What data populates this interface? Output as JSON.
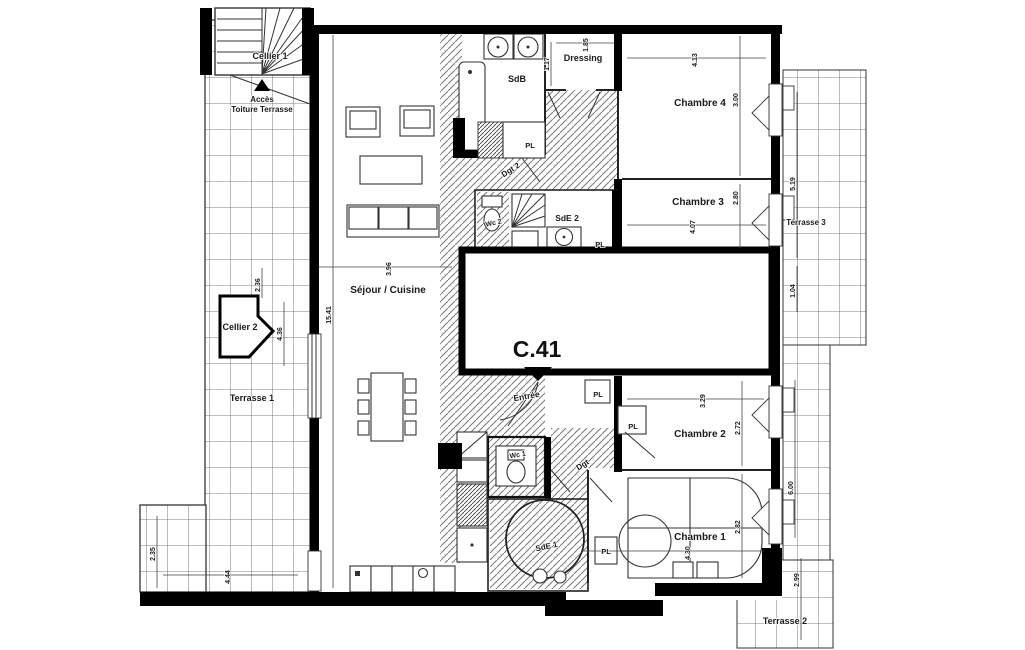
{
  "unit": {
    "label": "C.41"
  },
  "rooms": {
    "cellier1": "Cellier 1",
    "acces_line1": "Accès",
    "acces_line2": "Toiture Terrasse",
    "cellier2": "Cellier 2",
    "terrasse1": "Terrasse 1",
    "terrasse2": "Terrasse 2",
    "terrasse3": "Terrasse 3",
    "sejour": "Séjour / Cuisine",
    "sdb": "SdB",
    "dressing": "Dressing",
    "chambre4": "Chambre 4",
    "chambre3": "Chambre 3",
    "chambre2": "Chambre 2",
    "chambre1": "Chambre 1",
    "sde2": "SdE 2",
    "sde1": "SdE 1",
    "wc2": "Wc 2",
    "wc1": "Wc 1",
    "dgt2": "Dgt 2",
    "dgt": "Dgt",
    "entree": "Entrée",
    "pl": "PL"
  },
  "dims": {
    "sejour_w": "3.96",
    "sejour_h": "15.41",
    "chambre4_w": "4.13",
    "chambre4_h": "3.00",
    "chambre3_w": "4.07",
    "chambre3_h": "2.80",
    "chambre2_w": "3.29",
    "chambre2_h": "2.72",
    "chambre1_w": "4.30",
    "chambre1_h": "2.82",
    "dressing_w": "1.85",
    "dressing_h": "1.17",
    "cellier2_top": "2.36",
    "cellier2_side": "4.36",
    "terrasse1_h": "2.35",
    "terrasse1_w": "4.44",
    "terrasse3_h": "5.19",
    "terrasse3_low": "1.04",
    "terrasse2_side": "6.00",
    "terrasse2_h": "2.99"
  },
  "colors": {
    "wall": "#000000",
    "line": "#333333",
    "hatch": "#666666",
    "text": "#1a1a1a",
    "background": "#ffffff"
  }
}
